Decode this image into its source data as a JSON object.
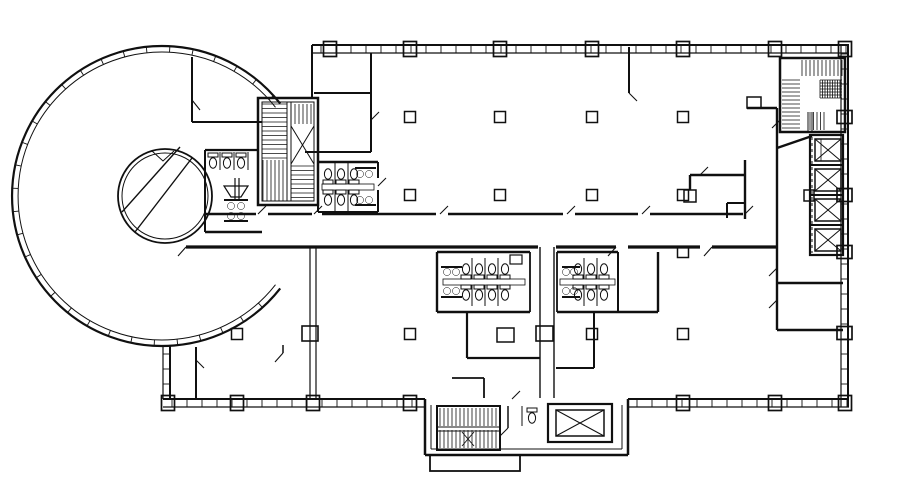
{
  "plan": {
    "background_color": "#ffffff",
    "line_color": "#101010",
    "drawing_type": "architectural floor plan",
    "features": [
      {
        "name": "circular-office-wing",
        "kind": "wing",
        "shape": "ring"
      },
      {
        "name": "central-drum-core",
        "kind": "core",
        "shape": "circle"
      },
      {
        "name": "northwest-scissor-stair",
        "kind": "stair"
      },
      {
        "name": "northeast-stair",
        "kind": "stair"
      },
      {
        "name": "south-stair",
        "kind": "stair"
      },
      {
        "name": "passenger-elevator-bank",
        "kind": "elevator",
        "count": 4
      },
      {
        "name": "freight-elevator",
        "kind": "elevator",
        "count": 1
      },
      {
        "name": "restroom-core-west",
        "kind": "restroom"
      },
      {
        "name": "restroom-core-north",
        "kind": "restroom"
      },
      {
        "name": "restroom-core-center-left",
        "kind": "restroom"
      },
      {
        "name": "restroom-core-center-right",
        "kind": "restroom"
      },
      {
        "name": "structural-column-grid",
        "kind": "columns"
      },
      {
        "name": "curtain-wall-windows",
        "kind": "exterior-wall"
      },
      {
        "name": "corridor-spine",
        "kind": "circulation"
      }
    ]
  }
}
